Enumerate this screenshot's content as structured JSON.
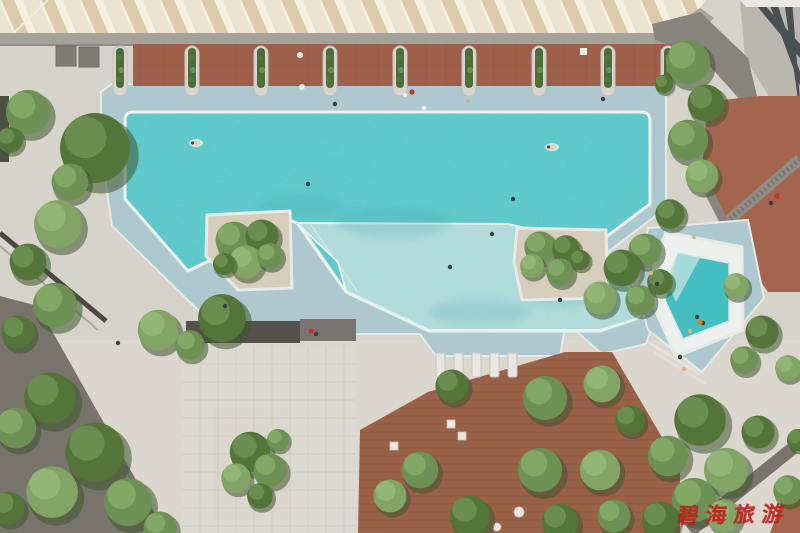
{
  "meta": {
    "title": "Aerial top-down photograph of a resort swimming pool complex",
    "width": 800,
    "height": 533
  },
  "watermark": {
    "text": "碧海旅游",
    "color": "#c2201a"
  },
  "palette": {
    "pavement": "#d6d3ca",
    "pavement2": "#ddd9d1",
    "roofBase": "#ece4d0",
    "roofShadow": "#d9c7a3",
    "roofLight": "#f6f1e0",
    "beam": "#a5a19b",
    "beamEdge": "#8e8a84",
    "cabana": "#9e604a",
    "cabanaLine": "#7e4b3a",
    "planterCurb": "#d8d5cf",
    "planterGreen": "#4e6b3b",
    "apron": "#adc8ce",
    "rim": "#edf0ec",
    "waterDeep": "#43bfc1",
    "waterDeepDark": "#239da4",
    "waterShallow": "#a4d5d5",
    "waterLedge": "#b5dedb",
    "island": "#d6cdbc",
    "deckWood": "#9a6149",
    "deckLine": "#7d4b38",
    "canopy": "#dcd9d1",
    "canopyLine": "#c7c4bc",
    "shadowBand": "#55524d",
    "roadDark": "#78736b",
    "benchDark": "#4b4843",
    "pathGray": "#87837d",
    "terracotta": "#a5644d",
    "building": "#bab7b1",
    "window": "#4a5052",
    "mullion": "#eae8e2",
    "treeDark": "#3f5530",
    "tree1": "#6d9154",
    "tree2": "#547539",
    "tree3": "#82a566",
    "tree1hi": "#86ac68",
    "tree2hi": "#6f9354",
    "tree3hi": "#97b87a",
    "darkLounger": "#807d76",
    "whiteFurniture": "#e9e7e1"
  },
  "scene": {
    "regions": [
      "sawtooth-roof-canopy",
      "gray-walkway-beam",
      "cabana-deck-row",
      "column-planters",
      "main-pool-deep-water",
      "shallow-pool-section",
      "island-planter-1",
      "island-planter-2",
      "kids-pool",
      "pool-apron",
      "stone-pavement",
      "white-pergola-canopy",
      "wood-sun-deck",
      "tower-facade",
      "terracotta-terrace",
      "lattice-screen",
      "asphalt-path",
      "garden-trees"
    ],
    "planter_columns_x": [
      120,
      192,
      261,
      330,
      400,
      469,
      539,
      608,
      668
    ],
    "loungers_x": [
      436,
      454,
      472,
      490,
      508
    ],
    "loungers_y": 353,
    "dark_loungers": [
      [
        56,
        46
      ],
      [
        79,
        47
      ]
    ],
    "deck_tables": [
      [
        447,
        420
      ],
      [
        458,
        432
      ],
      [
        390,
        442
      ]
    ],
    "round_tables": [
      [
        519,
        512,
        5
      ],
      [
        497,
        527,
        4
      ]
    ],
    "trees": [
      [
        28,
        112,
        24,
        0
      ],
      [
        10,
        140,
        14,
        1
      ],
      [
        95,
        148,
        38,
        1
      ],
      [
        70,
        182,
        20,
        0
      ],
      [
        58,
        224,
        26,
        2
      ],
      [
        28,
        262,
        20,
        1
      ],
      [
        55,
        305,
        24,
        0
      ],
      [
        18,
        332,
        18,
        1
      ],
      [
        50,
        398,
        28,
        1
      ],
      [
        16,
        428,
        22,
        0
      ],
      [
        95,
        452,
        32,
        1
      ],
      [
        52,
        492,
        28,
        2
      ],
      [
        128,
        502,
        26,
        0
      ],
      [
        8,
        508,
        18,
        1
      ],
      [
        160,
        528,
        18,
        0
      ],
      [
        158,
        330,
        22,
        2
      ],
      [
        222,
        318,
        26,
        1
      ],
      [
        190,
        345,
        16,
        0
      ],
      [
        234,
        240,
        20,
        0
      ],
      [
        262,
        236,
        18,
        1
      ],
      [
        246,
        262,
        18,
        2
      ],
      [
        270,
        256,
        14,
        0
      ],
      [
        224,
        264,
        12,
        1
      ],
      [
        540,
        247,
        17,
        0
      ],
      [
        566,
        249,
        15,
        1
      ],
      [
        532,
        266,
        13,
        2
      ],
      [
        560,
        272,
        15,
        0
      ],
      [
        580,
        260,
        11,
        1
      ],
      [
        250,
        452,
        22,
        1
      ],
      [
        270,
        470,
        18,
        0
      ],
      [
        236,
        478,
        16,
        2
      ],
      [
        260,
        496,
        14,
        1
      ],
      [
        278,
        440,
        12,
        0
      ],
      [
        688,
        62,
        24,
        0
      ],
      [
        706,
        103,
        20,
        1
      ],
      [
        688,
        140,
        22,
        0
      ],
      [
        702,
        176,
        18,
        2
      ],
      [
        670,
        214,
        16,
        1
      ],
      [
        645,
        250,
        18,
        0
      ],
      [
        622,
        268,
        20,
        1
      ],
      [
        600,
        298,
        18,
        2
      ],
      [
        640,
        300,
        16,
        0
      ],
      [
        660,
        282,
        14,
        1
      ],
      [
        736,
        286,
        14,
        2
      ],
      [
        762,
        332,
        18,
        1
      ],
      [
        744,
        360,
        15,
        0
      ],
      [
        788,
        368,
        14,
        2
      ],
      [
        664,
        84,
        10,
        1
      ],
      [
        700,
        420,
        28,
        1
      ],
      [
        668,
        456,
        22,
        0
      ],
      [
        726,
        470,
        24,
        2
      ],
      [
        758,
        432,
        18,
        1
      ],
      [
        694,
        500,
        24,
        0
      ],
      [
        660,
        520,
        20,
        1
      ],
      [
        788,
        490,
        16,
        0
      ],
      [
        724,
        516,
        18,
        2
      ],
      [
        798,
        440,
        12,
        1
      ],
      [
        452,
        386,
        18,
        1
      ],
      [
        545,
        398,
        24,
        0
      ],
      [
        602,
        384,
        20,
        2
      ],
      [
        630,
        420,
        16,
        1
      ],
      [
        420,
        470,
        20,
        0
      ],
      [
        390,
        496,
        18,
        2
      ],
      [
        470,
        516,
        22,
        1
      ],
      [
        540,
        470,
        24,
        0
      ],
      [
        600,
        470,
        22,
        2
      ],
      [
        560,
        522,
        20,
        1
      ],
      [
        614,
        516,
        18,
        0
      ]
    ],
    "people": [
      [
        196,
        143,
        "swim"
      ],
      [
        308,
        184,
        "dark"
      ],
      [
        513,
        199,
        "dark"
      ],
      [
        552,
        147,
        "swim"
      ],
      [
        603,
        99,
        "dark"
      ],
      [
        450,
        267,
        "dark"
      ],
      [
        492,
        234,
        "dark"
      ],
      [
        560,
        300,
        "dark"
      ],
      [
        412,
        92,
        "red"
      ],
      [
        424,
        108,
        "white"
      ],
      [
        468,
        101,
        "skin"
      ],
      [
        335,
        104,
        "dark"
      ],
      [
        405,
        95,
        "white"
      ],
      [
        225,
        306,
        "dark"
      ],
      [
        118,
        343,
        "dark"
      ],
      [
        311,
        331,
        "red"
      ],
      [
        316,
        334,
        "dark"
      ],
      [
        777,
        196,
        "red"
      ],
      [
        771,
        203,
        "dark"
      ],
      [
        694,
        237,
        "skin"
      ],
      [
        651,
        273,
        "skin"
      ],
      [
        657,
        284,
        "dark"
      ],
      [
        697,
        317,
        "dark"
      ],
      [
        703,
        323,
        "dark"
      ],
      [
        690,
        331,
        "skin"
      ],
      [
        680,
        357,
        "dark"
      ],
      [
        684,
        369,
        "skin"
      ],
      [
        700,
        322,
        "orange"
      ]
    ]
  }
}
